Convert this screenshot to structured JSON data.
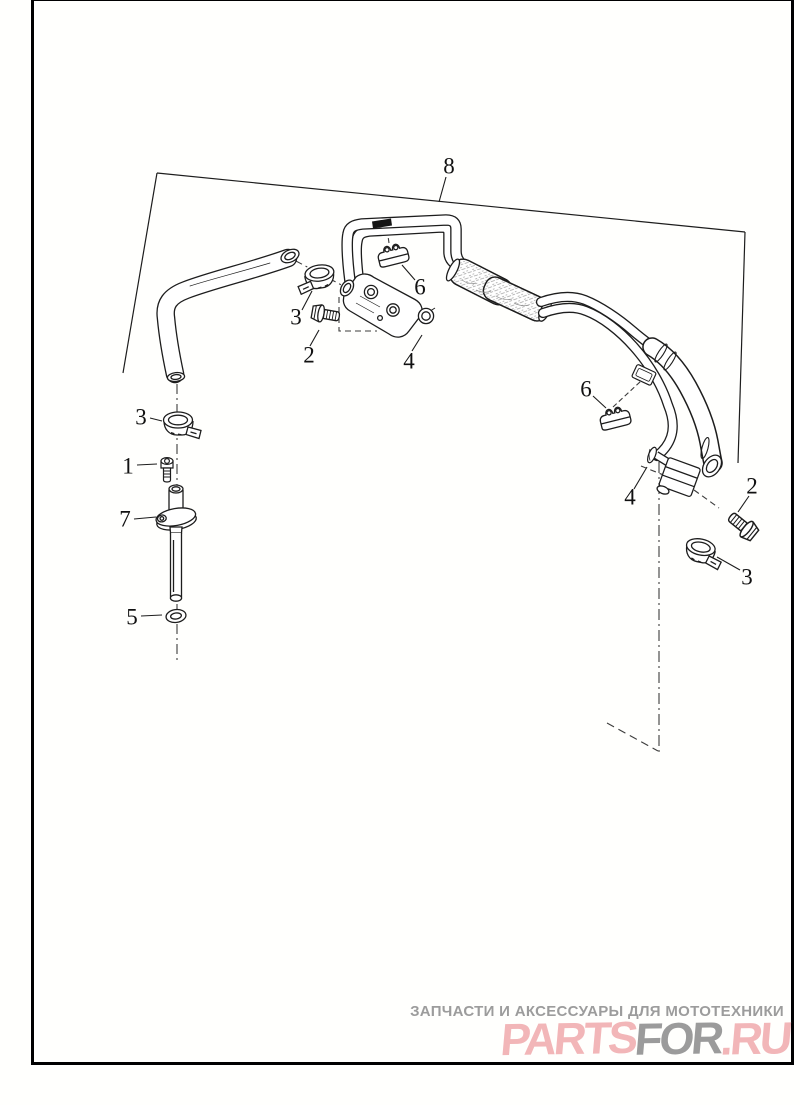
{
  "page": {
    "background": "#fffffd",
    "frame_color": "#000000"
  },
  "diagram": {
    "description": "Exploded parts diagram of motorcycle oil/fuel line hose assembly",
    "line_color": "#1d1d1d",
    "dash_color": "#3c3c3c",
    "label_color": "#111111",
    "callouts": [
      {
        "n": "8",
        "x": 449,
        "y": 166
      },
      {
        "n": "3",
        "x": 296,
        "y": 317
      },
      {
        "n": "2",
        "x": 309,
        "y": 355
      },
      {
        "n": "4",
        "x": 409,
        "y": 361
      },
      {
        "n": "6",
        "x": 420,
        "y": 287
      },
      {
        "n": "3",
        "x": 141,
        "y": 417
      },
      {
        "n": "1",
        "x": 128,
        "y": 466
      },
      {
        "n": "7",
        "x": 125,
        "y": 519
      },
      {
        "n": "5",
        "x": 132,
        "y": 617
      },
      {
        "n": "6",
        "x": 586,
        "y": 389
      },
      {
        "n": "4",
        "x": 630,
        "y": 497
      },
      {
        "n": "2",
        "x": 752,
        "y": 486
      },
      {
        "n": "3",
        "x": 747,
        "y": 577
      }
    ]
  },
  "watermark": {
    "tagline": "ЗАПЧАСТИ И АКСЕССУАРЫ ДЛЯ МОТОТЕХНИКИ",
    "tagline_color": "#9c9c9c",
    "logo_segments": [
      {
        "text": "PARTS",
        "color": "#f2b6b8"
      },
      {
        "text": "FOR",
        "color": "#9b9b9b"
      },
      {
        "text": ".RU",
        "color": "#f2b6b8"
      }
    ]
  }
}
